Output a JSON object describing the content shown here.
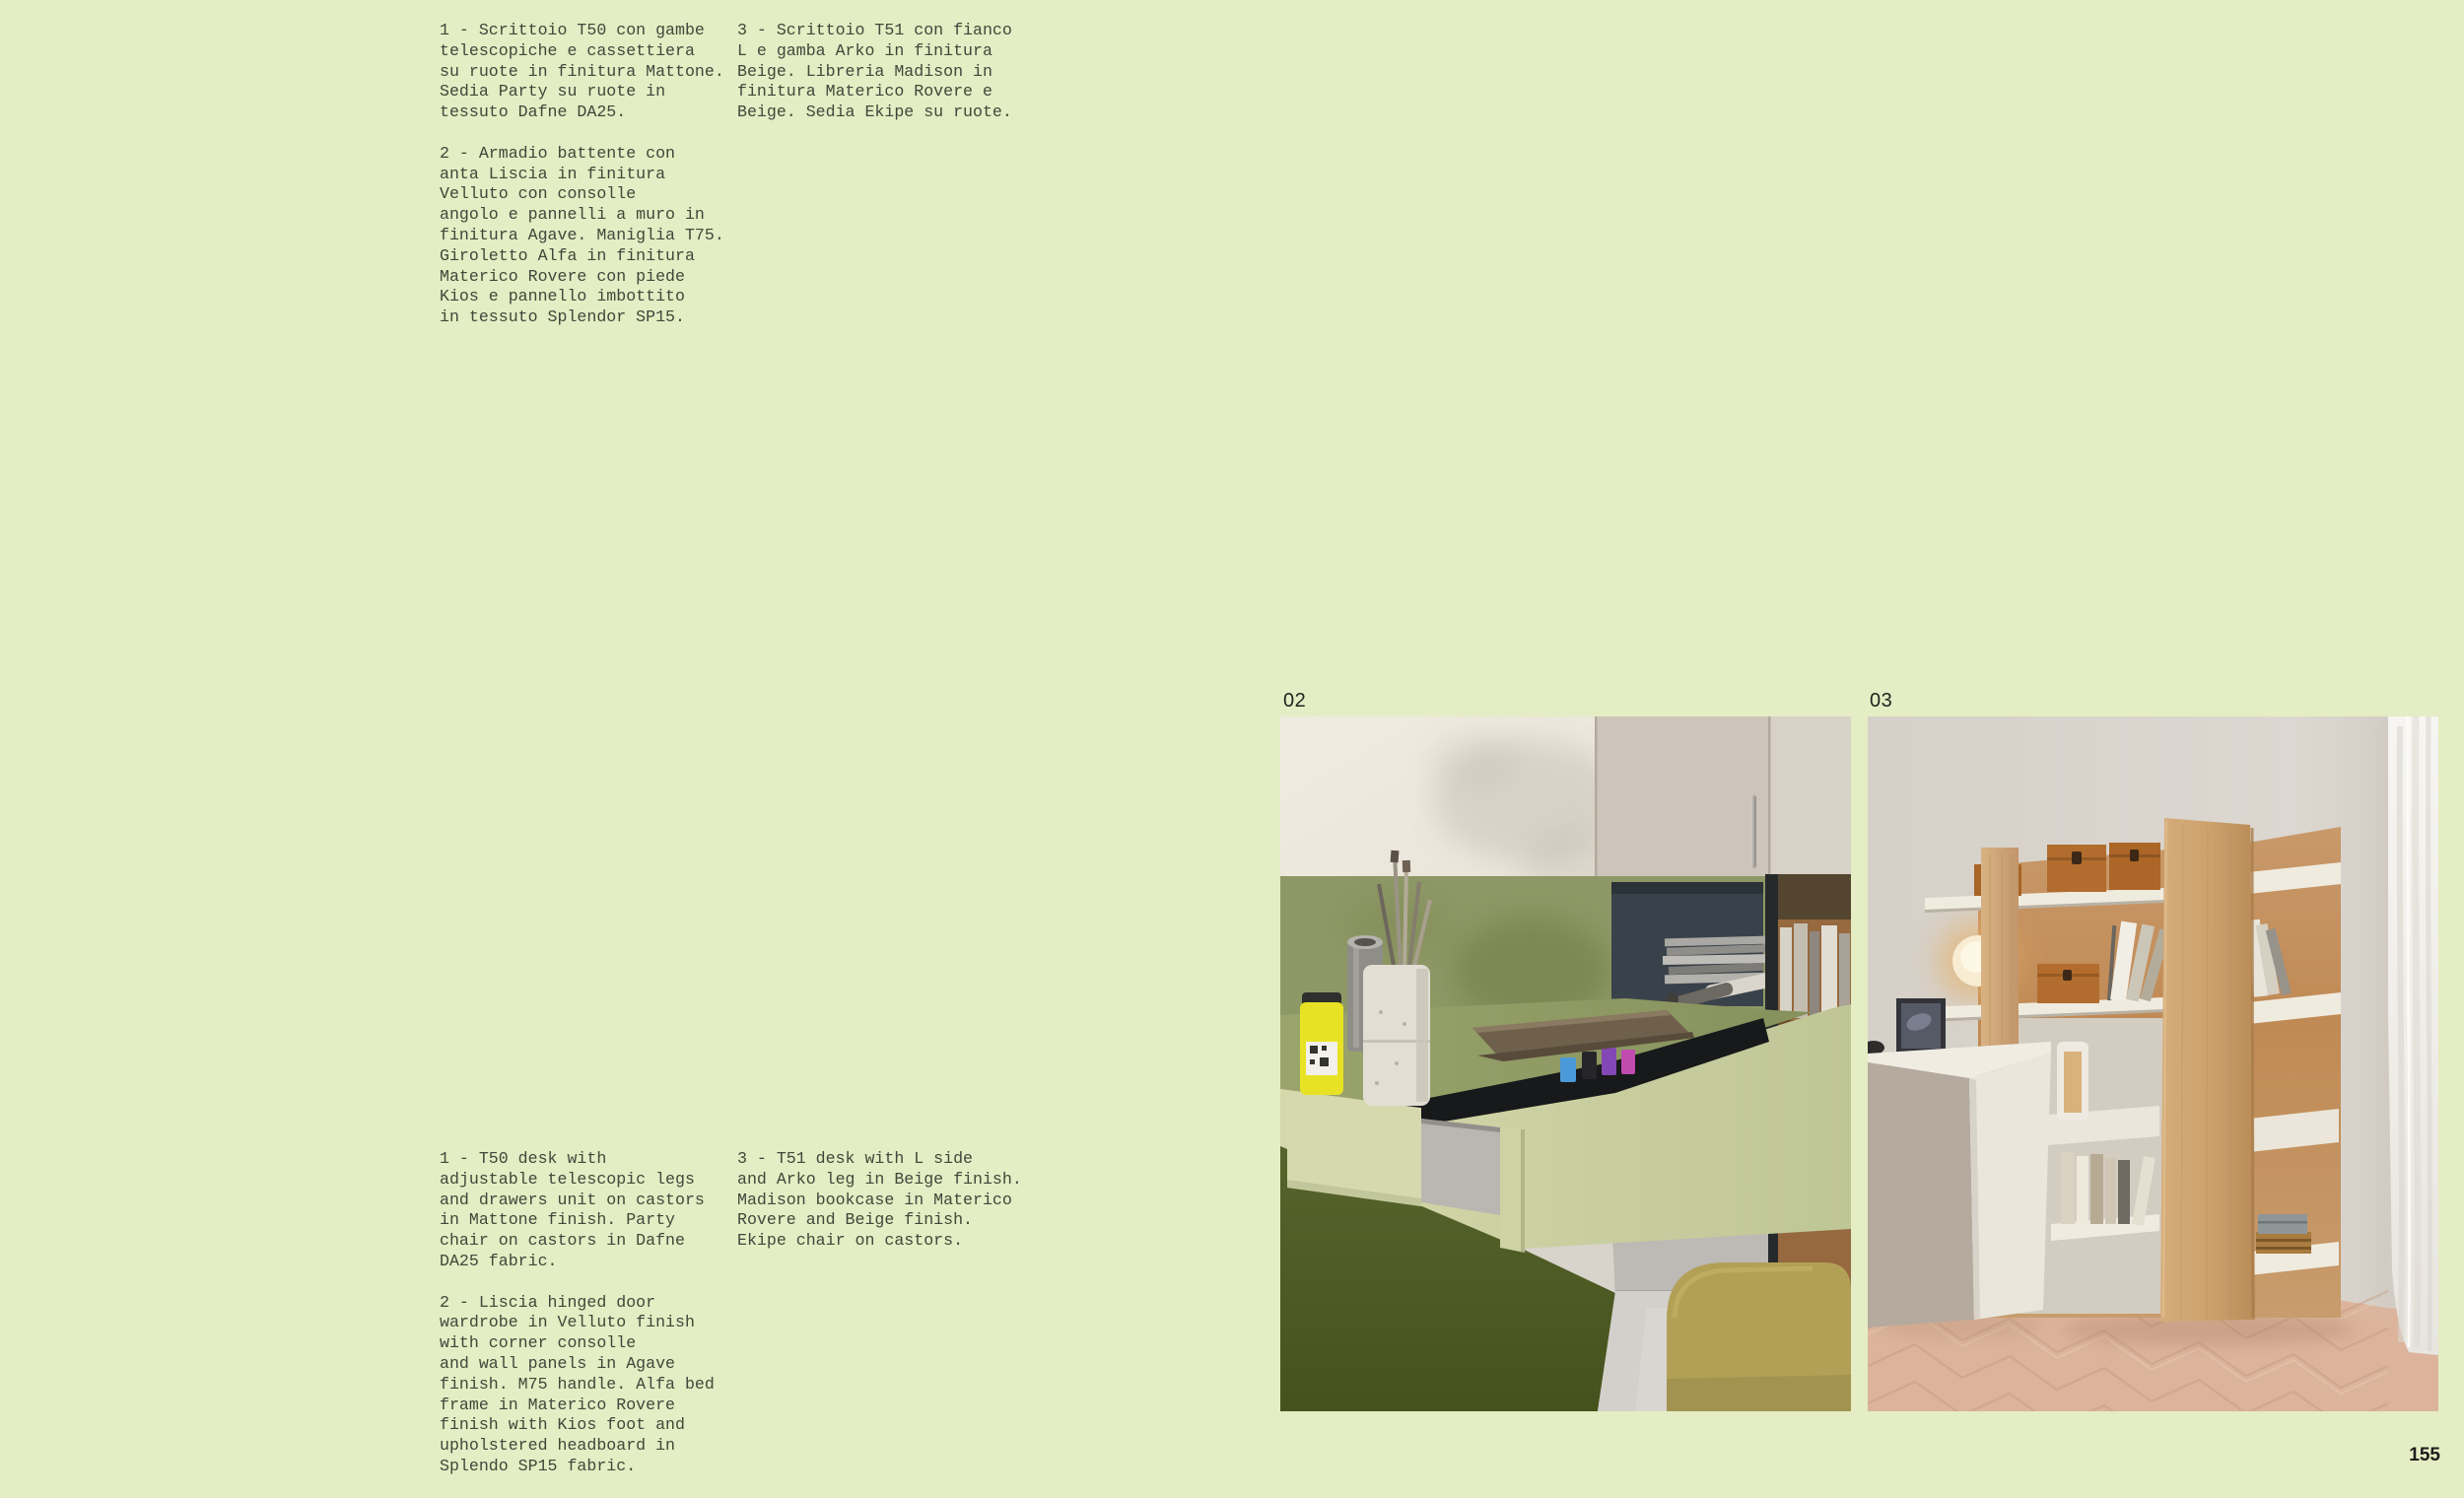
{
  "page": {
    "background_color": "#e4edc3",
    "page_number": "155"
  },
  "captions": {
    "italian": {
      "item_1": "1 - Scrittoio T50 con gambe\ntelescopiche e cassettiera\nsu ruote in finitura Mattone.\nSedia Party su ruote in\ntessuto Dafne DA25.",
      "item_2": "2 - Armadio battente con\nanta Liscia in finitura\nVelluto con consolle\nangolo e pannelli a muro in\nfinitura Agave. Maniglia T75.\nGiroletto Alfa in finitura\nMaterico Rovere con piede\nKios e pannello imbottito\nin tessuto Splendor SP15.",
      "item_3": "3 - Scrittoio T51 con fianco\nL e gamba Arko in finitura\nBeige. Libreria Madison in\nfinitura Materico Rovere e\nBeige. Sedia Ekipe su ruote."
    },
    "english": {
      "item_1": "1 - T50 desk with\nadjustable telescopic legs\nand drawers unit on castors\nin Mattone finish. Party\nchair on castors in Dafne\nDA25 fabric.",
      "item_2": "2 - Liscia hinged door\nwardrobe in Velluto finish\nwith corner consolle\nand wall panels in Agave\nfinish. M75 handle. Alfa bed\nframe in Materico Rovere\nfinish with Kios foot and\nupholstered headboard in\nSplendo SP15 fabric.",
      "item_3": "3 - T51 desk with L side\nand Arko leg in Beige finish.\nMadison bookcase in Materico\nRovere and Beige finish.\nEkipe chair on castors."
    }
  },
  "figures": {
    "fig_02": {
      "label": "02",
      "alt": "Scrittoio T50: green desk with open drawer and drawers unit, wall cabinets, shelf niche with magazines, wooden bookcase and olive pouf"
    },
    "fig_03": {
      "label": "03",
      "alt": "Libreria Madison: oak bookcase with white shelves, storage boxes and lamp, white desk, herringbone wood floor and white curtain"
    }
  },
  "colors": {
    "caption_text": "#42473b",
    "label_text": "#222420",
    "desk_green_light": "#ced3a5",
    "wall_sage": "#8e9866",
    "dark_olive": "#53602a",
    "oak_wood": "#cda26d",
    "box_orange": "#b26d2e",
    "floor_herringbone": "#dcb49c"
  }
}
